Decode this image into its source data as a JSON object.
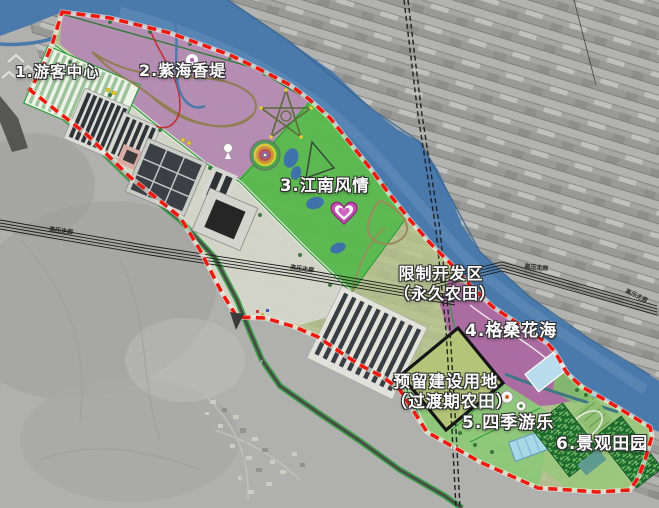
{
  "map": {
    "zone_labels": [
      "1.游客中心",
      "2.紫海香堤",
      "3.江南风情",
      "4.格桑花海",
      "5.四季游乐",
      "6.景观田园"
    ],
    "restricted_area": {
      "line1": "限制开发区",
      "line2": "（永久农田）"
    },
    "reserved_area": {
      "line1": "预留建设用地",
      "line2": "（过渡期农田）"
    },
    "power_corridor": "高压走廊",
    "colors": {
      "boundary_red": "#ee1a10",
      "river_blue": "#4a7aac",
      "zone2_purple": "#b48ab4",
      "zone3_green": "#57b84e",
      "zone4_magenta": "#ab67a3",
      "farmland_olive": "#b9c48b",
      "maze_green": "#1d6c2f",
      "road_green": "#2f9e3b"
    }
  }
}
